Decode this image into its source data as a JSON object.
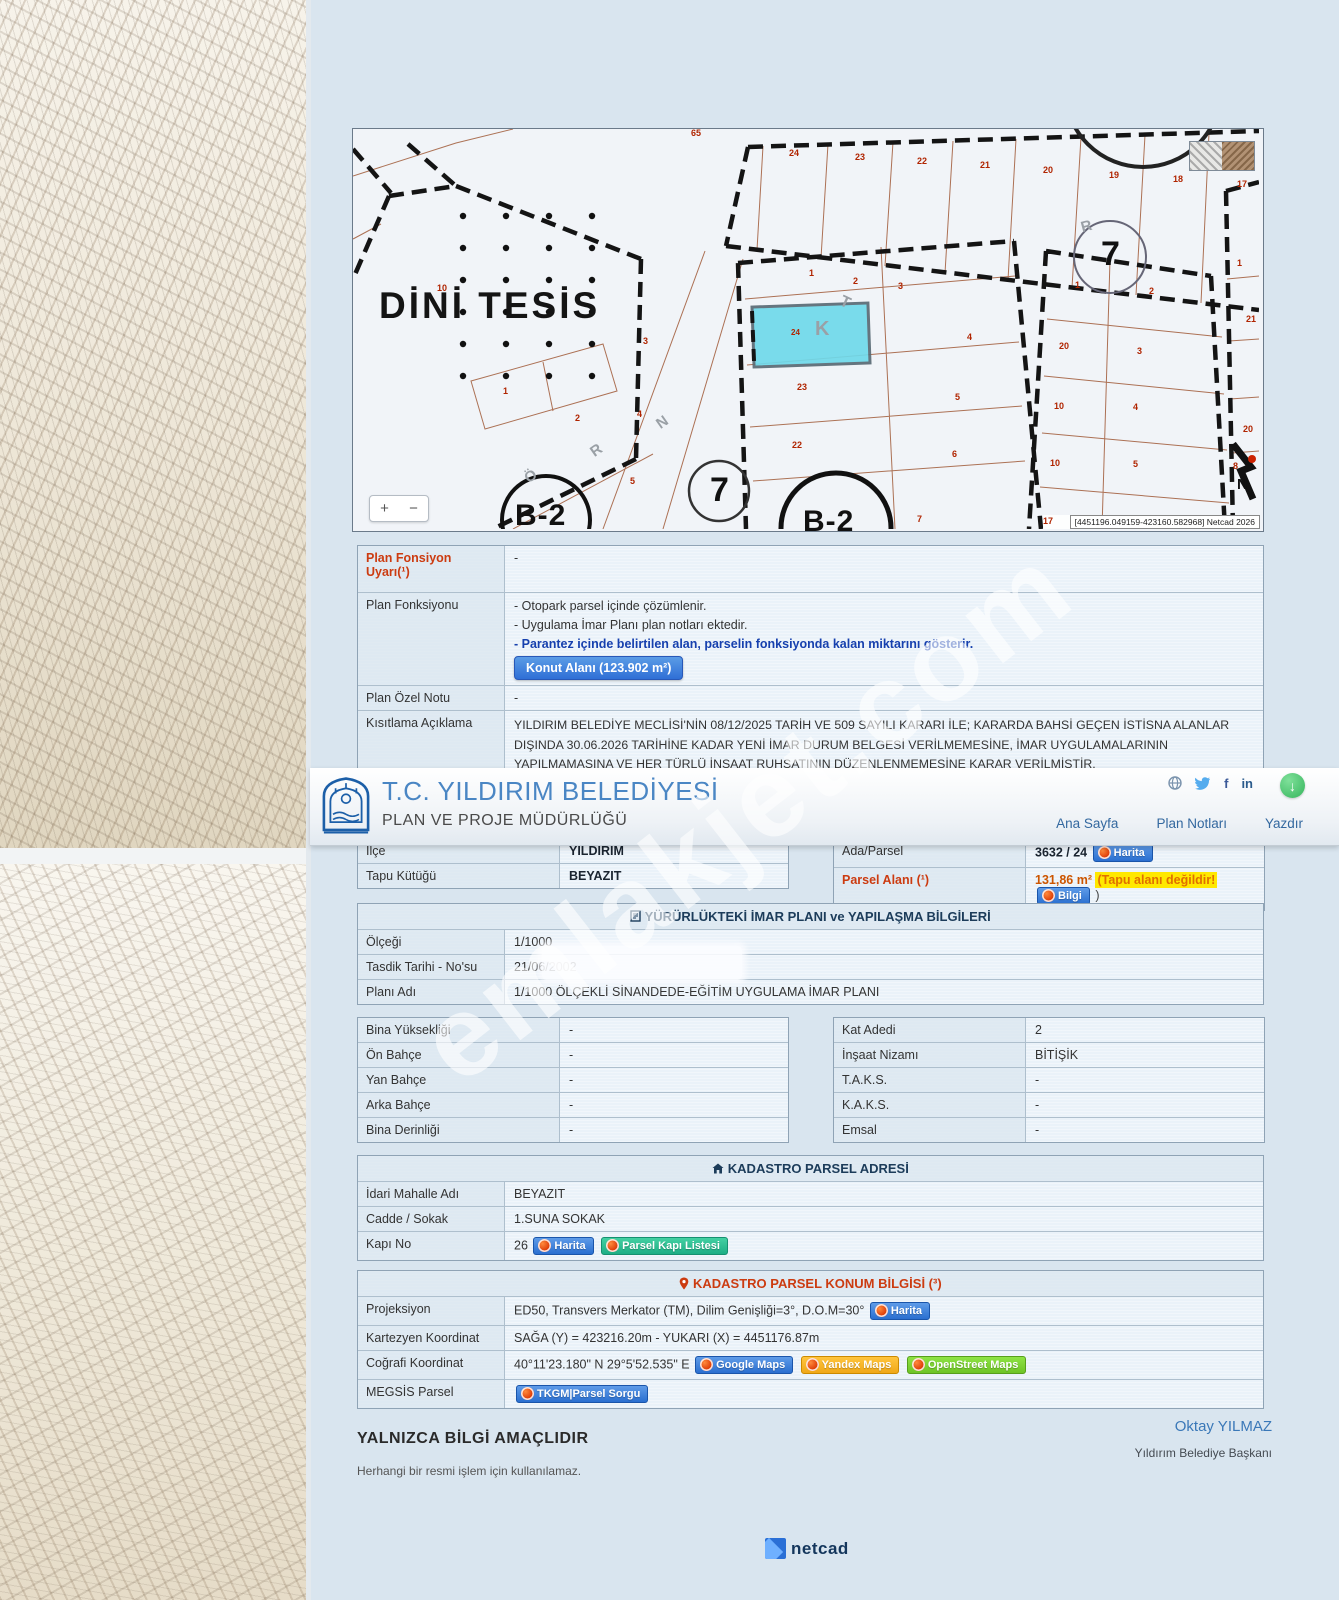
{
  "watermark": "emlakjet.com",
  "header": {
    "title": "T.C. YILDIRIM BELEDİYESİ",
    "subtitle": "PLAN VE PROJE MÜDÜRLÜĞÜ",
    "nav": [
      "Ana Sayfa",
      "Plan Notları",
      "Yazdır"
    ],
    "download_glyph": "↓"
  },
  "icons": {
    "section_imar": "clipboard-icon",
    "section_adres": "home-icon",
    "section_konum": "location-pin-icon",
    "social": [
      "globe-icon",
      "twitter-icon",
      "facebook-icon",
      "linkedin-icon"
    ],
    "facebook_glyph": "f",
    "linkedin_glyph": "in"
  },
  "map": {
    "zoom_in": "+",
    "zoom_out": "−",
    "coords_text": "[4451196.049159-423160.582968] Netcad 2026",
    "labels": [
      {
        "t": "65",
        "x": 338,
        "y": 0
      },
      {
        "t": "24",
        "x": 436,
        "y": 20
      },
      {
        "t": "23",
        "x": 502,
        "y": 24
      },
      {
        "t": "22",
        "x": 564,
        "y": 28
      },
      {
        "t": "21",
        "x": 627,
        "y": 32
      },
      {
        "t": "20",
        "x": 690,
        "y": 37
      },
      {
        "t": "19",
        "x": 756,
        "y": 42
      },
      {
        "t": "18",
        "x": 820,
        "y": 46
      },
      {
        "t": "17",
        "x": 884,
        "y": 51
      },
      {
        "t": "10",
        "x": 84,
        "y": 155
      },
      {
        "t": "1",
        "x": 150,
        "y": 258
      },
      {
        "t": "2",
        "x": 222,
        "y": 285
      },
      {
        "t": "1",
        "x": 456,
        "y": 140
      },
      {
        "t": "2",
        "x": 500,
        "y": 148
      },
      {
        "t": "3",
        "x": 545,
        "y": 153
      },
      {
        "t": "3",
        "x": 290,
        "y": 208
      },
      {
        "t": "4",
        "x": 284,
        "y": 281
      },
      {
        "t": "5",
        "x": 277,
        "y": 348
      },
      {
        "t": "24",
        "x": 438,
        "y": 200,
        "s": 8
      },
      {
        "t": "4",
        "x": 614,
        "y": 204
      },
      {
        "t": "23",
        "x": 444,
        "y": 254
      },
      {
        "t": "5",
        "x": 602,
        "y": 264
      },
      {
        "t": "22",
        "x": 439,
        "y": 312
      },
      {
        "t": "6",
        "x": 599,
        "y": 321
      },
      {
        "t": "7",
        "x": 564,
        "y": 386
      },
      {
        "t": "1",
        "x": 722,
        "y": 152
      },
      {
        "t": "2",
        "x": 796,
        "y": 158
      },
      {
        "t": "20",
        "x": 706,
        "y": 213
      },
      {
        "t": "3",
        "x": 784,
        "y": 218
      },
      {
        "t": "10",
        "x": 701,
        "y": 273
      },
      {
        "t": "4",
        "x": 780,
        "y": 274
      },
      {
        "t": "10",
        "x": 697,
        "y": 330
      },
      {
        "t": "5",
        "x": 780,
        "y": 331
      },
      {
        "t": "17",
        "x": 690,
        "y": 388
      },
      {
        "t": "1",
        "x": 884,
        "y": 130
      },
      {
        "t": "21",
        "x": 893,
        "y": 186
      },
      {
        "t": "20",
        "x": 890,
        "y": 296
      },
      {
        "t": "8",
        "x": 880,
        "y": 333
      },
      {
        "t": "K",
        "x": 462,
        "y": 190,
        "cls": "glet",
        "s": 20
      },
      {
        "t": "T",
        "x": 487,
        "y": 166,
        "cls": "glet",
        "s": 16,
        "r": 25
      },
      {
        "t": "Ö",
        "x": 172,
        "y": 340,
        "cls": "glet",
        "s": 15,
        "r": -35
      },
      {
        "t": "R",
        "x": 238,
        "y": 314,
        "cls": "glet",
        "s": 15,
        "r": -35
      },
      {
        "t": "N",
        "x": 304,
        "y": 286,
        "cls": "glet",
        "s": 15,
        "r": -35
      },
      {
        "t": "R",
        "x": 728,
        "y": 90,
        "cls": "glet",
        "s": 15,
        "r": -15
      },
      {
        "t": "DİNİ TESİS",
        "x": 26,
        "y": 158,
        "cls": "bigtxt"
      },
      {
        "t": "7",
        "x": 357,
        "y": 344,
        "cls": "circ7"
      },
      {
        "t": "7",
        "x": 748,
        "y": 108,
        "cls": "circ7"
      },
      {
        "t": "B-2",
        "x": 162,
        "y": 372,
        "cls": "b2"
      },
      {
        "t": "B-2",
        "x": 450,
        "y": 378,
        "cls": "b2"
      },
      {
        "t": "N",
        "x": 884,
        "y": 348,
        "cls": "north"
      }
    ]
  },
  "plan_info": {
    "warning_label": "Plan Fonsiyon Uyarı(¹)",
    "warning_value": "-",
    "function_label": "Plan Fonksiyonu",
    "function_lines": [
      "- Otopark parsel içinde çözümlenir.",
      "- Uygulama İmar Planı plan notları ektedir.",
      "- Parantez içinde belirtilen alan, parselin fonksiyonda kalan miktarını gösterir."
    ],
    "function_button": "Konut Alanı (123.902 m²)",
    "special_note_label": "Plan Özel Notu",
    "special_note_value": "-",
    "restriction_label": "Kısıtlama Açıklama",
    "restriction_value": "YILDIRIM BELEDİYE MECLİSİ'NİN 08/12/2025 TARİH VE 509 SAYILI KARARI İLE; KARARDA BAHSİ GEÇEN İSTİSNA ALANLAR DIŞINDA 30.06.2026 TARİHİNE KADAR YENİ İMAR DURUM BELGESİ VERİLMEMESİNE, İMAR UYGULAMALARININ YAPILMAMASINA VE HER TÜRLÜ İNŞAAT RUHSATININ DÜZENLENMEMESİNE KARAR VERİLMİŞTİR."
  },
  "location": {
    "ilce_label": "İlçe",
    "ilce": "YILDIRIM",
    "tapu_label": "Tapu Kütüğü",
    "tapu": "BEYAZIT",
    "ada_label": "Ada/Parsel",
    "ada": "3632 / 24",
    "harita_btn": "Harita",
    "parsel_alani_label": "Parsel Alanı (¹)",
    "parsel_alani": "131,86 m²",
    "tapu_warning": "(Tapu alanı değildir!",
    "bilgi_btn": "Bilgi",
    "paren_close": ")"
  },
  "imar": {
    "header": "YÜRÜRLÜKTEKİ İMAR PLANI ve YAPILAŞMA BİLGİLERİ",
    "rows": [
      [
        "Ölçeği",
        "1/1000"
      ],
      [
        "Tasdik Tarihi - No'su",
        "21/06/2002"
      ],
      [
        "Planı Adı",
        "1/1000 ÖLÇEKLİ SİNANDEDE-EĞİTİM UYGULAMA İMAR PLANI"
      ]
    ]
  },
  "yapilasma": {
    "left": [
      [
        "Bina Yüksekliği",
        "-"
      ],
      [
        "Ön Bahçe",
        "-"
      ],
      [
        "Yan Bahçe",
        "-"
      ],
      [
        "Arka Bahçe",
        "-"
      ],
      [
        "Bina Derinliği",
        "-"
      ]
    ],
    "right": [
      [
        "Kat Adedi",
        "2"
      ],
      [
        "İnşaat Nizamı",
        "BİTİŞİK"
      ],
      [
        "T.A.K.S.",
        "-"
      ],
      [
        "K.A.K.S.",
        "-"
      ],
      [
        "Emsal",
        "-"
      ]
    ]
  },
  "adres": {
    "header": "KADASTRO PARSEL ADRESİ",
    "mahalle_label": "İdari Mahalle Adı",
    "mahalle": "BEYAZIT",
    "cadde_label": "Cadde / Sokak",
    "cadde": "1.SUNA SOKAK",
    "kapi_label": "Kapı No",
    "kapi_no": "26",
    "harita_btn": "Harita",
    "kapi_listesi_btn": "Parsel Kapı Listesi"
  },
  "konum": {
    "header": "KADASTRO PARSEL KONUM BİLGİSİ (³)",
    "proj_label": "Projeksiyon",
    "proj_value": "ED50, Transvers Merkator (TM), Dilim Genişliği=3°, D.O.M=30°",
    "harita_btn": "Harita",
    "kartezyen_label": "Kartezyen Koordinat",
    "kartezyen_value": "SAĞA (Y) = 423216.20m - YUKARI (X) = 4451176.87m",
    "cografi_label": "Coğrafi Koordinat",
    "cografi_value": "40°11'23.180\" N 29°5'52.535\" E",
    "gmaps_btn": "Google Maps",
    "ymaps_btn": "Yandex Maps",
    "osm_btn": "OpenStreet Maps",
    "megsis_label": "MEGSİS Parsel",
    "tkgm_btn": "TKGM|Parsel Sorgu"
  },
  "footer": {
    "disclaimer": "YALNIZCA BİLGİ AMAÇLIDIR",
    "disclaimer_sub": "Herhangi bir resmi işlem için kullanılamaz.",
    "mayor": "Oktay YILMAZ",
    "mayor_title": "Yıldırım Belediye Başkanı",
    "netcad": "netcad"
  }
}
